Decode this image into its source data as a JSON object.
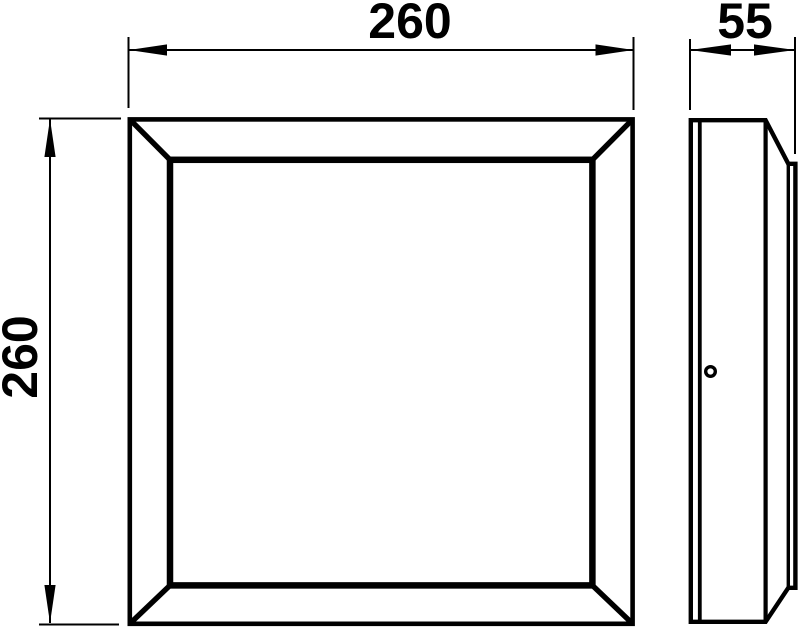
{
  "colors": {
    "line": "#000000",
    "background": "#ffffff"
  },
  "dimensions": {
    "front_width_label": "260",
    "front_height_label": "260",
    "side_depth_label": "55"
  },
  "chart_data": {
    "type": "table",
    "title": "Technical dimension drawing of square luminaire",
    "values": {
      "front_width_mm": 260,
      "front_height_mm": 260,
      "depth_mm": 55
    }
  }
}
